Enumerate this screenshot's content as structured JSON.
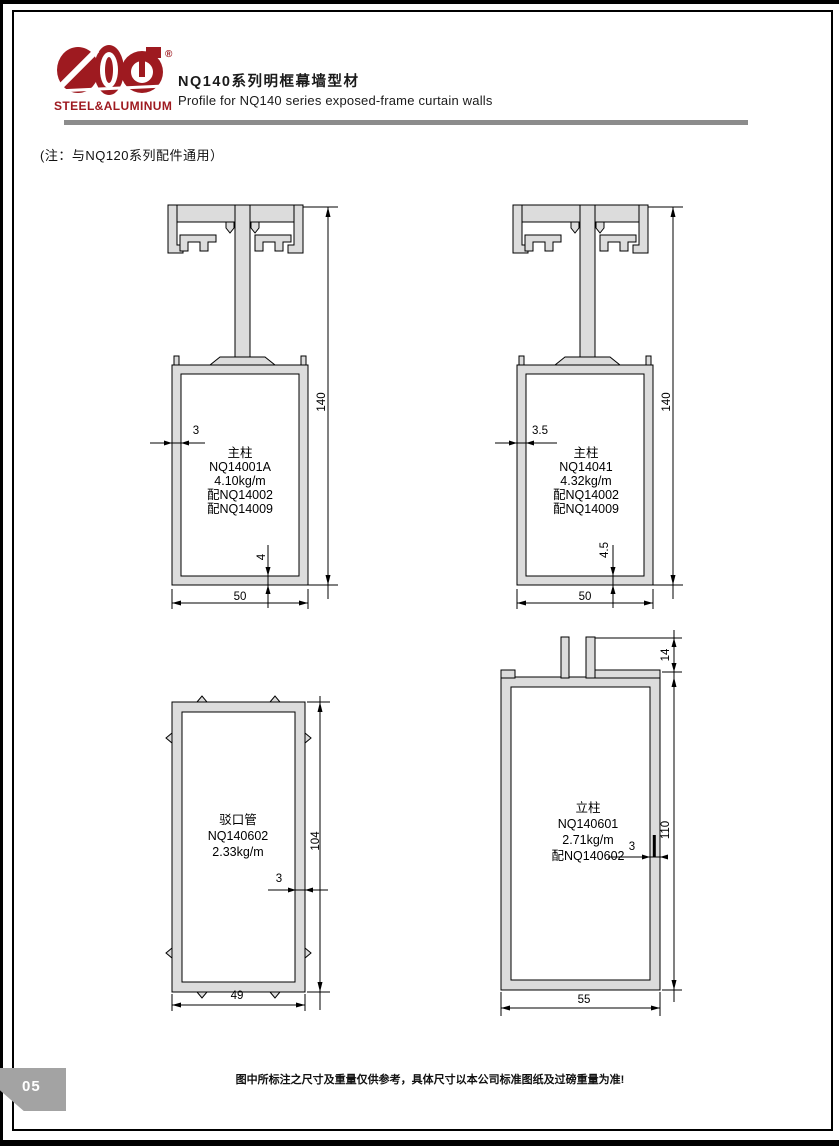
{
  "page": {
    "number": "05",
    "title_zh": "NQ140系列明框幕墙型材",
    "title_en": "Profile for NQ140 series exposed-frame curtain walls",
    "note": "(注：与NQ120系列配件通用）",
    "footer": "图中所标注之尺寸及重量仅供参考，具体尺寸以本公司标准图纸及过磅重量为准!"
  },
  "logo": {
    "text": "STEEL&ALUMINUM",
    "mark": "®"
  },
  "colors": {
    "brand_red": "#9e1a20",
    "profile_fill": "#dcdcdc",
    "divider_gray": "#8c8c8c",
    "tab_gray": "#a3a3a3"
  },
  "drawings": [
    {
      "name": "主柱",
      "code": "NQ14001A",
      "weight": "4.10kg/m",
      "accessories": [
        "配NQ14002",
        "配NQ14009"
      ],
      "dims": {
        "wall": "3",
        "height": "140",
        "bottom_wall": "4",
        "width": "50"
      }
    },
    {
      "name": "主柱",
      "code": "NQ14041",
      "weight": "4.32kg/m",
      "accessories": [
        "配NQ14002",
        "配NQ14009"
      ],
      "dims": {
        "wall": "3.5",
        "height": "140",
        "bottom_wall": "4.5",
        "width": "50"
      }
    },
    {
      "name": "驳口管",
      "code": "NQ140602",
      "weight": "2.33kg/m",
      "accessories": [],
      "dims": {
        "height": "104",
        "wall": "3",
        "width": "49"
      }
    },
    {
      "name": "立柱",
      "code": "NQ140601",
      "weight": "2.71kg/m",
      "accessories": [
        "配NQ140602"
      ],
      "dims": {
        "tab": "14",
        "height": "110",
        "wall": "3",
        "width": "55"
      }
    }
  ]
}
